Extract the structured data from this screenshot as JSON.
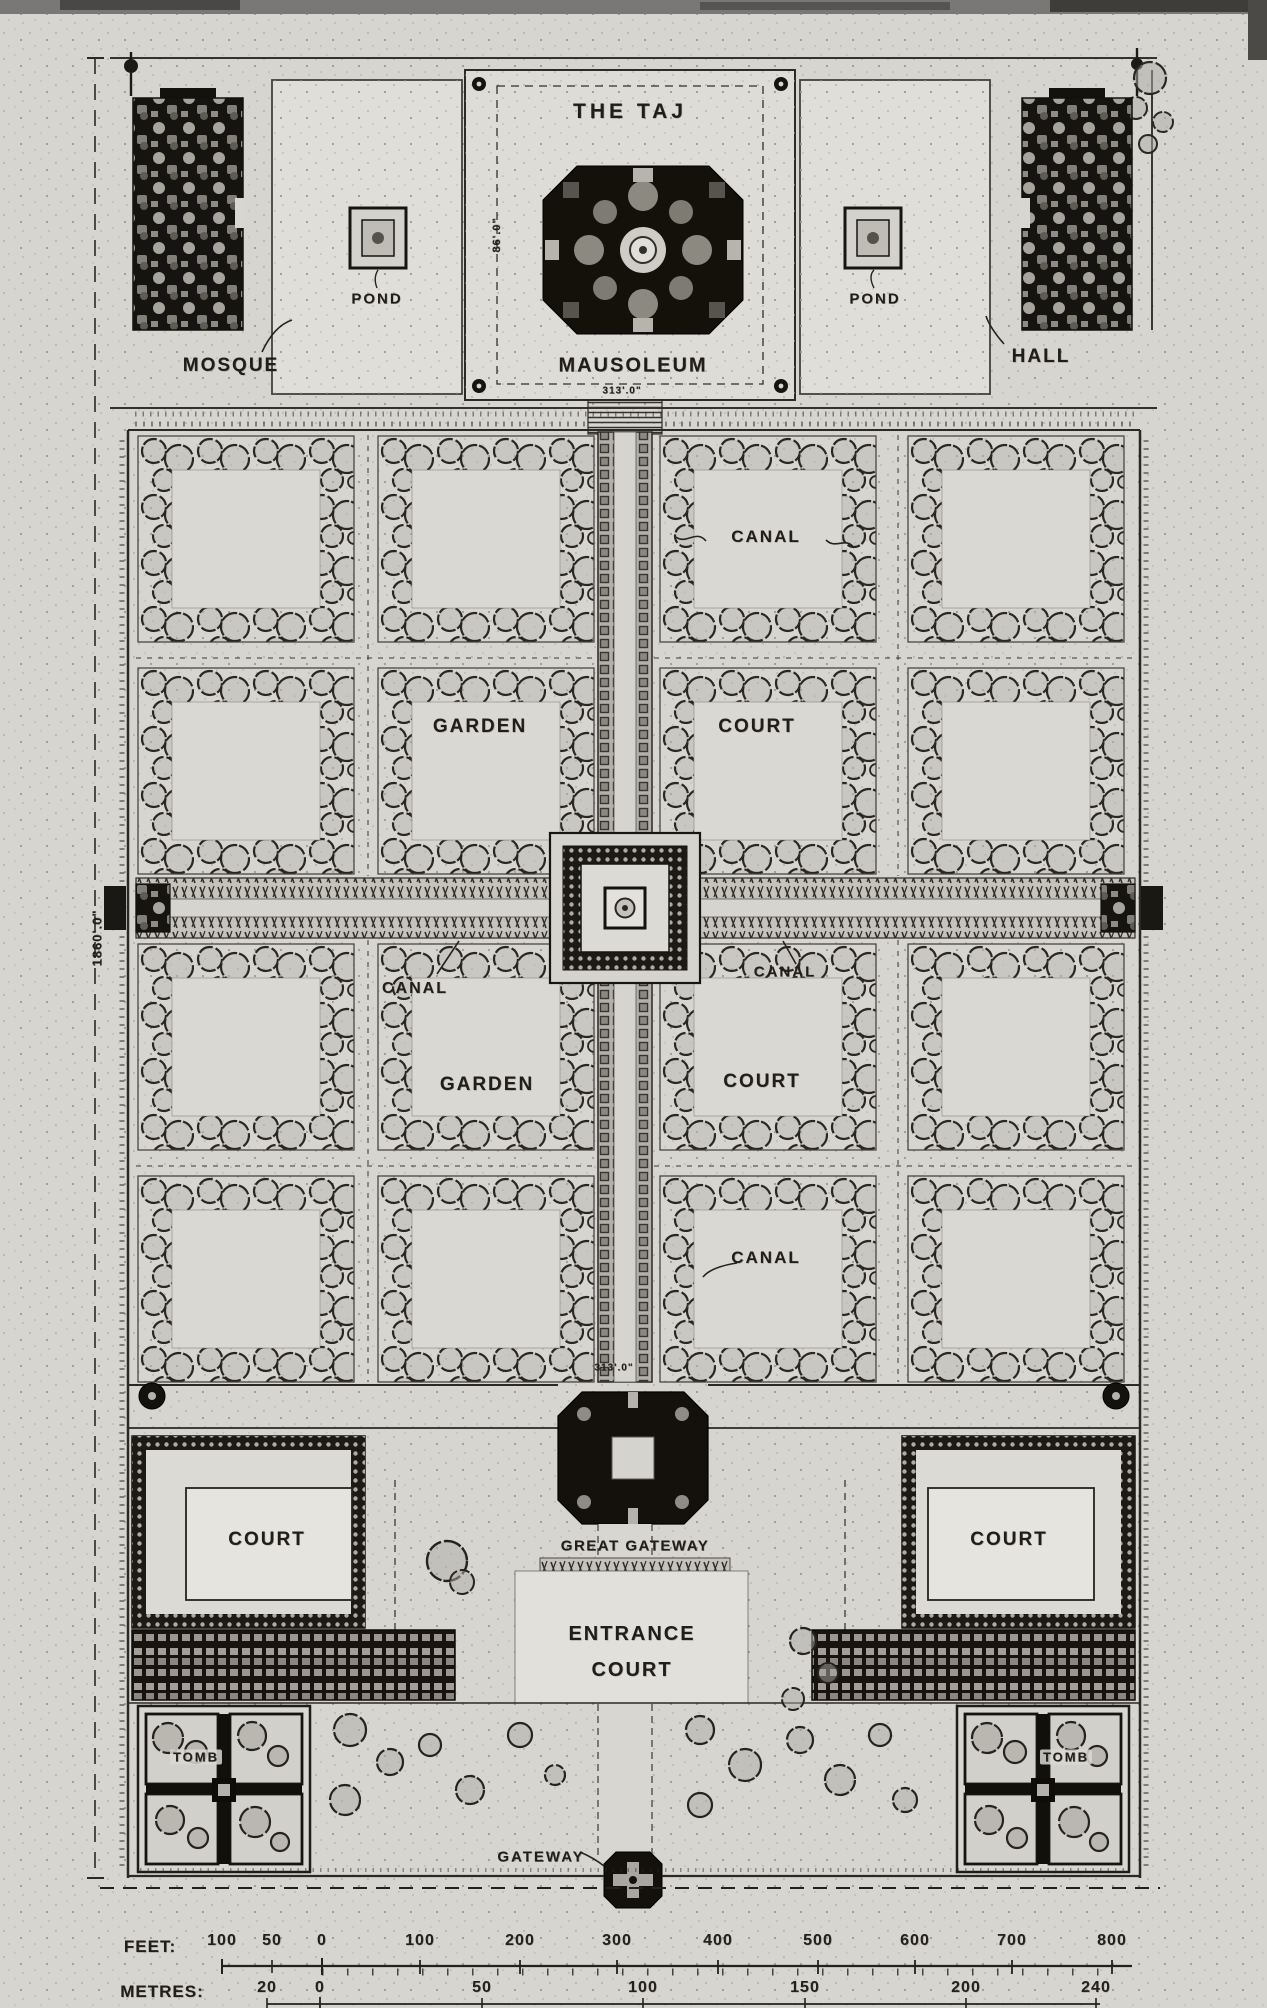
{
  "terrace": {
    "title": "THE TAJ",
    "mausoleum": "MAUSOLEUM",
    "mosque": "MOSQUE",
    "hall": "HALL",
    "pond_left": "POND",
    "pond_right": "POND",
    "dim_platform": "86'.0\"",
    "dim_mausoleum": "313'.0\""
  },
  "garden": {
    "canal_top": "CANAL",
    "garden_upper": "GARDEN",
    "court_upper": "COURT",
    "canal_west": "CANAL",
    "canal_east": "CANAL",
    "garden_lower": "GARDEN",
    "court_lower": "COURT",
    "canal_south": "CANAL",
    "dim_total_length": "1860'.0\"",
    "dim_gateway": "313'.0\""
  },
  "forecourt": {
    "great_gateway": "GREAT GATEWAY",
    "entrance_line1": "ENTRANCE",
    "entrance_line2": "COURT",
    "court_west": "COURT",
    "court_east": "COURT"
  },
  "outer_court": {
    "tomb_west": "TOMB",
    "tomb_east": "TOMB",
    "gateway": "GATEWAY"
  },
  "scale": {
    "feet_label": "FEET:",
    "metres_label": "METRES:",
    "feet_marks": [
      "100",
      "50",
      "0",
      "100",
      "200",
      "300",
      "400",
      "500",
      "600",
      "700",
      "800"
    ],
    "metres_marks": [
      "20",
      "0",
      "50",
      "100",
      "150",
      "200",
      "240"
    ]
  },
  "colors": {
    "paper": "#d7d5d0",
    "ink": "#1d1b17",
    "building_dark": "#14120e"
  }
}
